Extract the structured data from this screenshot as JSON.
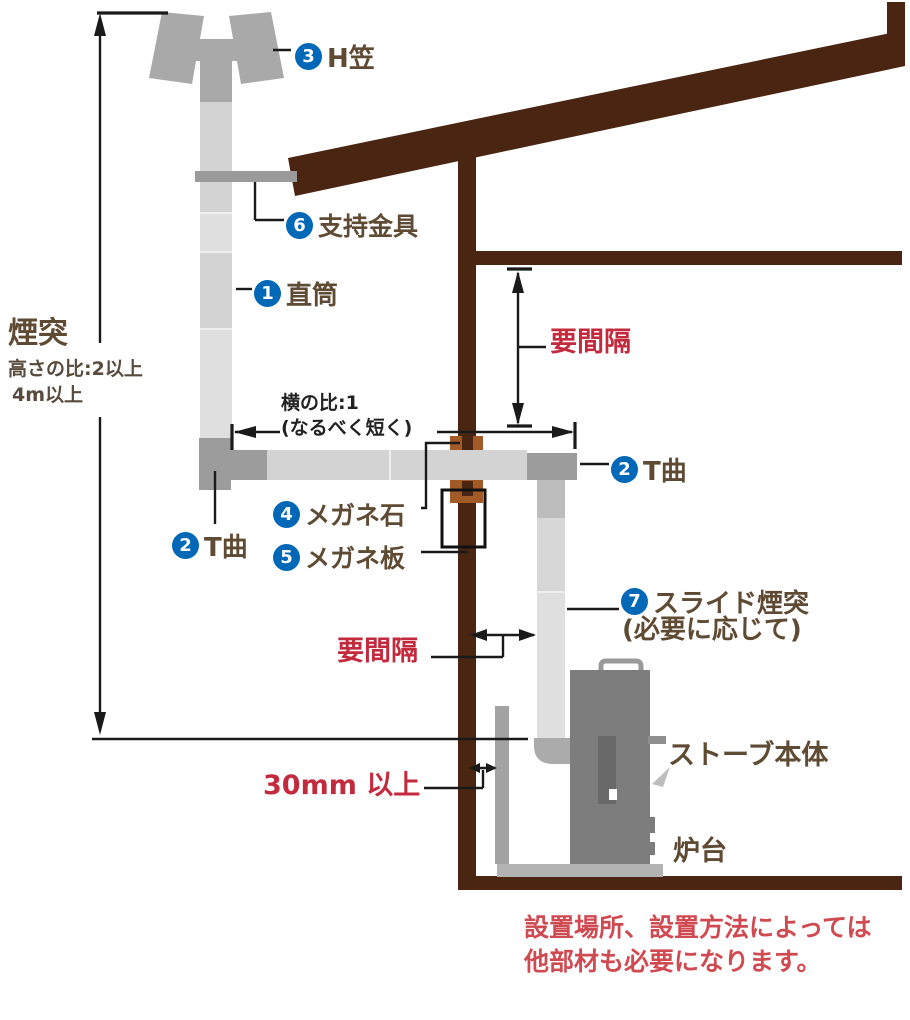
{
  "colors": {
    "wood": "#4a2511",
    "sienna": "#a25a26",
    "brown-text": "#5f4a33",
    "note-text": "#584a3c",
    "red": "#c42a3d",
    "red-light": "#d04a52",
    "blue": "#0068b7",
    "ink": "#1a1a1a",
    "pipe": "#d3d3d3",
    "pipe-alt": "#dfdfdf",
    "fitting": "#9c9c9c",
    "cap": "#a9a9a9",
    "stove": "#7d7d7d",
    "door": "#696969",
    "shield": "#a3a3a3",
    "hearth": "#b3b3b3"
  },
  "left_dim": {
    "title": "煙突",
    "note1": "高さの比:2以上",
    "note2": "4m以上"
  },
  "callouts": {
    "straight_pipe": {
      "num": "1",
      "label": "直筒"
    },
    "t_bend_left": {
      "num": "2",
      "label": "T曲"
    },
    "t_bend_right": {
      "num": "2",
      "label": "T曲"
    },
    "h_cap": {
      "num": "3",
      "label": "H笠"
    },
    "wall_thimble": {
      "num": "4",
      "label": "メガネ石"
    },
    "wall_plate": {
      "num": "5",
      "label": "メガネ板"
    },
    "support_bracket": {
      "num": "6",
      "label": "支持金具"
    },
    "slide_pipe": {
      "num": "7",
      "label": "スライド煙突",
      "sub": "(必要に応じて)"
    }
  },
  "dims": {
    "horiz_ratio": "横の比:1",
    "horiz_note": "(なるべく短く)",
    "gap_upper": "要間隔",
    "gap_side": "要間隔",
    "gap_floor": "30mm 以上"
  },
  "parts": {
    "stove": "ストーブ本体",
    "hearth": "炉台"
  },
  "footnote": {
    "line1": "設置場所、設置方法によっては",
    "line2": "他部材も必要になります。"
  }
}
